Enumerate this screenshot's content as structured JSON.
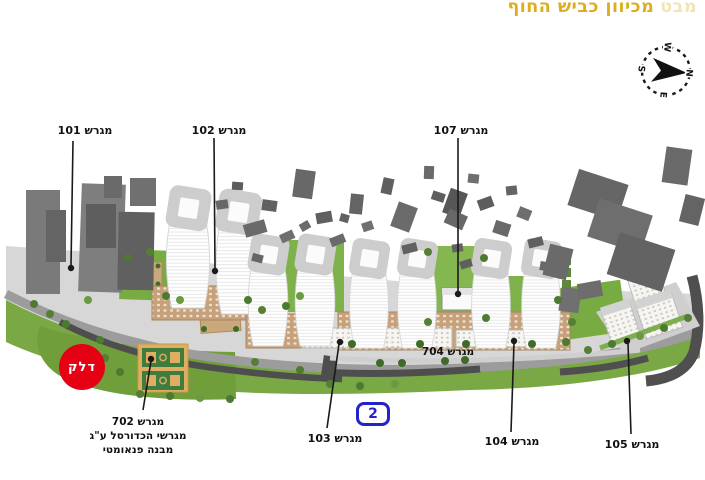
{
  "title": {
    "faded_word": "מבט",
    "text": "מכיוון כביש החוף"
  },
  "compass": {
    "north": "N",
    "east": "E",
    "south": "S",
    "west": "W"
  },
  "plot_labels": {
    "p101": "מגרש 101",
    "p102": "מגרש 102",
    "p107": "מגרש 107",
    "p103": "מגרש 103",
    "p104": "מגרש 104",
    "p105": "מגרש 105",
    "p704": "מגרש 704",
    "p702_line1": "מגרש 702",
    "p702_line2": "מגרשי הכדורסל ע\"ג",
    "p702_line3": "מבנה פנאומטי"
  },
  "road_badge": {
    "number": "2"
  },
  "fuel_station": {
    "logo_text": "דלק"
  },
  "colors": {
    "title_gold": "#dcae1f",
    "route_blue": "#2323cb",
    "delek_red": "#e60013",
    "greenery": "#7aa845",
    "ground": "#d7d7d7",
    "context_gray": "#6a6a6a",
    "road_dark": "#4f4f4f",
    "podium_tan": "#c6a17b"
  }
}
